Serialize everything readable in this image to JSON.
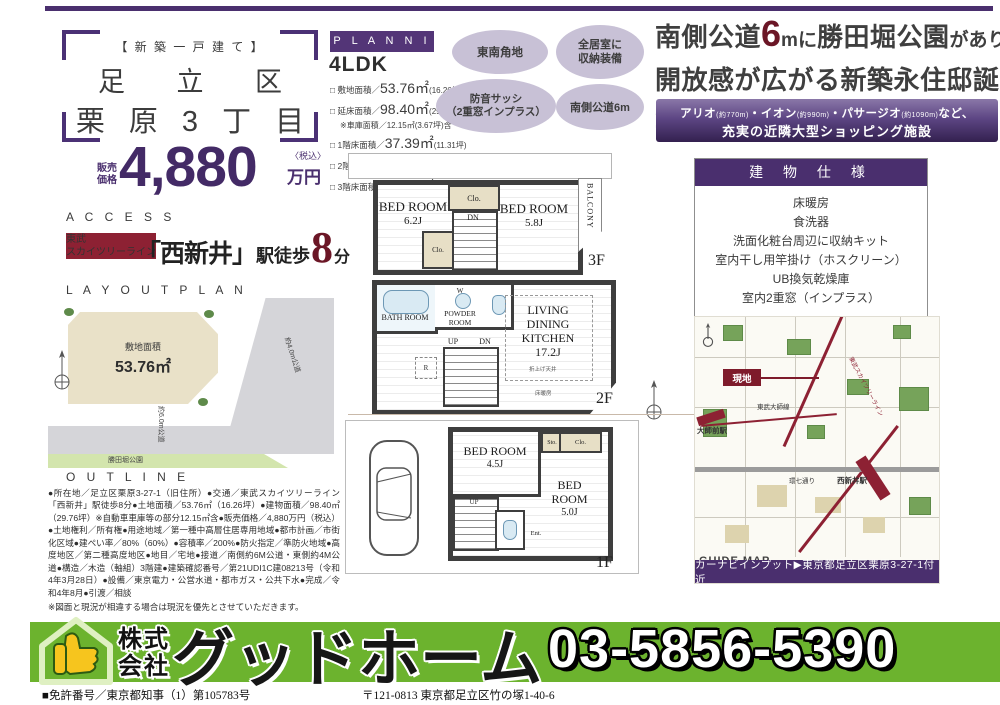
{
  "colors": {
    "accent_purple": "#4a2f6e",
    "accent_maroon": "#6b1626",
    "footer_green": "#6cb32e",
    "badge_lavender": "#c8c1d6"
  },
  "title_block": {
    "tag": "【 新 築 一 戸 建 て 】",
    "line1": "足 立 区",
    "line2": "栗 原 3 丁 目",
    "price_label1": "販売",
    "price_label2": "価格",
    "price_value": "4,880",
    "price_tax": "〈税込〉",
    "price_unit": "万円",
    "access_label": "A C C E S S",
    "rail1": "東武",
    "rail2": "スカイツリーライン",
    "station": "「西新井」",
    "walk": "駅徒歩",
    "walk_num": "8",
    "walk_unit": "分"
  },
  "planning": {
    "label": "P L A N N I N G",
    "type": "4LDK",
    "rows": [
      {
        "label": "□ 敷地面積／",
        "value": "53.76㎡",
        "tsubo": "(16.26坪)"
      },
      {
        "label": "□ 延床面積／",
        "value": "98.40㎡",
        "tsubo": "(29.76坪)"
      },
      {
        "note": "※車庫面積／12.15㎡(3.67坪)含"
      },
      {
        "label": "□ 1階床面積／",
        "value": "37.39㎡",
        "tsubo": "(11.31坪)"
      },
      {
        "label": "□ 2階床面積／",
        "value": "37.39㎡",
        "tsubo": "(11.31坪)"
      },
      {
        "label": "□ 3階床面積／",
        "value": "23.62㎡",
        "tsubo": "( 7.14坪)"
      }
    ]
  },
  "badges": {
    "b1": "東南角地",
    "b2a": "全居室に",
    "b2b": "収納装備",
    "b3a": "防音サッシ",
    "b3b": "（2重窓インプラス）",
    "b4": "南側公道6m"
  },
  "headline": {
    "pre": "南側公道",
    "num": "6",
    "mid": "mに",
    "park": "勝田堀公園",
    "suf": "があり",
    "line2": "開放感が広がる新築永住邸誕生。"
  },
  "shopping": {
    "s1": "アリオ",
    "d1": "(約770m)",
    "s2": "・イオン",
    "d2": "(約990m)",
    "s3": "・パサージオ",
    "d3": "(約1090m)",
    "s4": "など、",
    "line2": "充実の近隣大型ショッピング施設"
  },
  "specs": {
    "title": "建 物 仕 様",
    "items": [
      "床暖房",
      "食洗器",
      "洗面化粧台周辺に収納キット",
      "室内干し用竿掛け（ホスクリーン）",
      "UB換気乾燥庫",
      "室内2重窓（インプラス）"
    ]
  },
  "layout": {
    "label": "L A Y O U T   P L A N",
    "area_label": "敷地面積",
    "area_value": "53.76㎡",
    "road_east": "約4.0m公道",
    "road_south": "約6.0m公道",
    "park": "勝田堀公園"
  },
  "floors": {
    "f3": {
      "bed1": "BED ROOM",
      "bed1_size": "6.2J",
      "bed2": "BED ROOM",
      "bed2_size": "5.8J",
      "clo": "Clo.",
      "clo2": "Clo.",
      "dn": "DN",
      "balcony": "BALCONY",
      "label": "3F"
    },
    "f2": {
      "bath": "BATH ROOM",
      "powder": "POWDER ROOM",
      "w": "W",
      "ldk1": "LIVING",
      "ldk2": "DINING",
      "ldk3": "KITCHEN",
      "ldk_size": "17.2J",
      "ceiling": "折上げ天井",
      "heat": "床暖房",
      "up": "UP",
      "dn": "DN",
      "r": "R",
      "label": "2F"
    },
    "f1": {
      "bed1": "BED ROOM",
      "bed1_size": "4.5J",
      "bed2": "BED ROOM",
      "bed2_size": "5.0J",
      "sto": "Sto.",
      "clo": "Clo.",
      "ent": "Ent.",
      "up": "UP",
      "label": "1F"
    }
  },
  "map": {
    "genchi": "現地",
    "daishimae": "大師前駅",
    "nishiarai": "西新井駅",
    "daishi_line": "東武大師線",
    "skytree_line": "東武スカイツリーライン",
    "kannana": "環七通り",
    "guide": "GUIDE MAP",
    "navi": "カーナビインプット▶東京都足立区栗原3-27-1付近"
  },
  "outline": {
    "label": "O U T L I N E",
    "text": "●所在地／足立区栗原3-27-1（旧住所）●交通／東武スカイツリーライン「西新井」駅徒歩8分●土地面積／53.76㎡（16.26坪）●建物面積／98.40㎡（29.76坪）※自動車車庫等の部分12.15㎡含●販売価格／4,880万円（税込）●土地権利／所有権●用途地域／第一種中高層住居専用地域●都市計画／市街化区域●建ぺい率／80%（60%）●容積率／200%●防火指定／準防火地域●高度地区／第二種高度地区●地目／宅地●接道／南側約6M公道・東側約4M公道●構造／木造（軸組）3階建●建築確認番号／第21UDI1C建08213号（令和4年3月28日）●設備／東京電力・公営水道・都市ガス・公共下水●完成／令和4年8月●引渡／相談",
    "note": "※図面と現況が相違する場合は現況を優先とさせていただきます。"
  },
  "footer": {
    "co1": "株式",
    "co2": "会社",
    "name": "グッドホーム",
    "phone": "03-5856-5390",
    "license": "■免許番号／東京都知事（1）第105783号",
    "address": "〒121-0813 東京都足立区竹の塚1-40-6"
  }
}
